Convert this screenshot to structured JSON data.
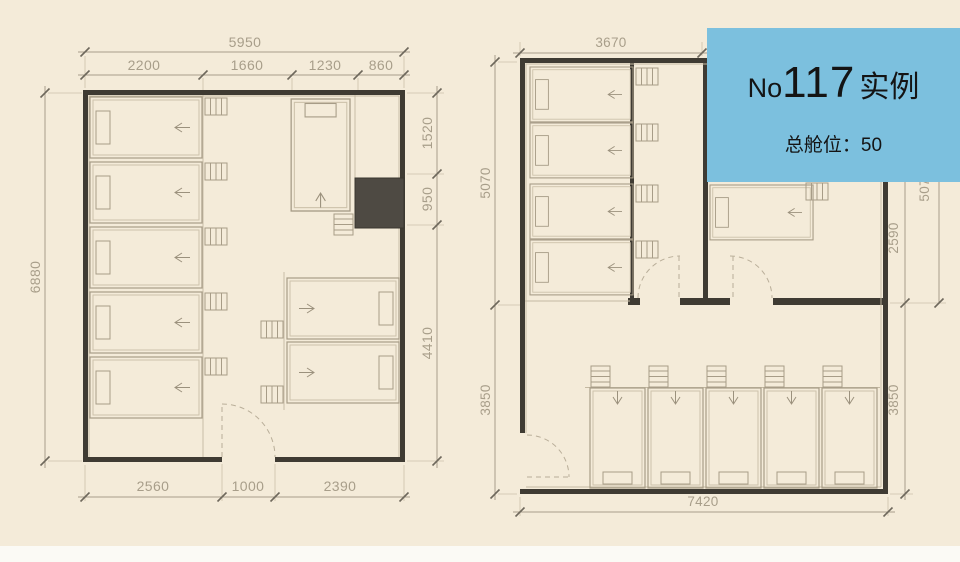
{
  "badge": {
    "title_prefix": "No",
    "title_number": "117",
    "title_suffix": "实例",
    "subtitle": "总舱位：50"
  },
  "left_plan": {
    "dims": {
      "total_width": "5950",
      "segments_top": [
        "2200",
        "1660",
        "1230",
        "860"
      ],
      "height": "6880",
      "right": [
        "1520",
        "950",
        "4410"
      ],
      "bottom": [
        "2560",
        "1000",
        "2390"
      ]
    }
  },
  "right_plan": {
    "dims": {
      "top_width": "3670",
      "left": [
        "5070",
        "3850"
      ],
      "right": [
        "2590",
        "3850"
      ],
      "right_outer": "5070",
      "bottom_width": "7420"
    }
  },
  "colors": {
    "background": "#f4ebd9",
    "wall": "#3f3b33",
    "dimension": "#a89e8a",
    "dark_block": "#4e4a43",
    "badge_background": "#7cc0de",
    "badge_text": "#141414"
  }
}
